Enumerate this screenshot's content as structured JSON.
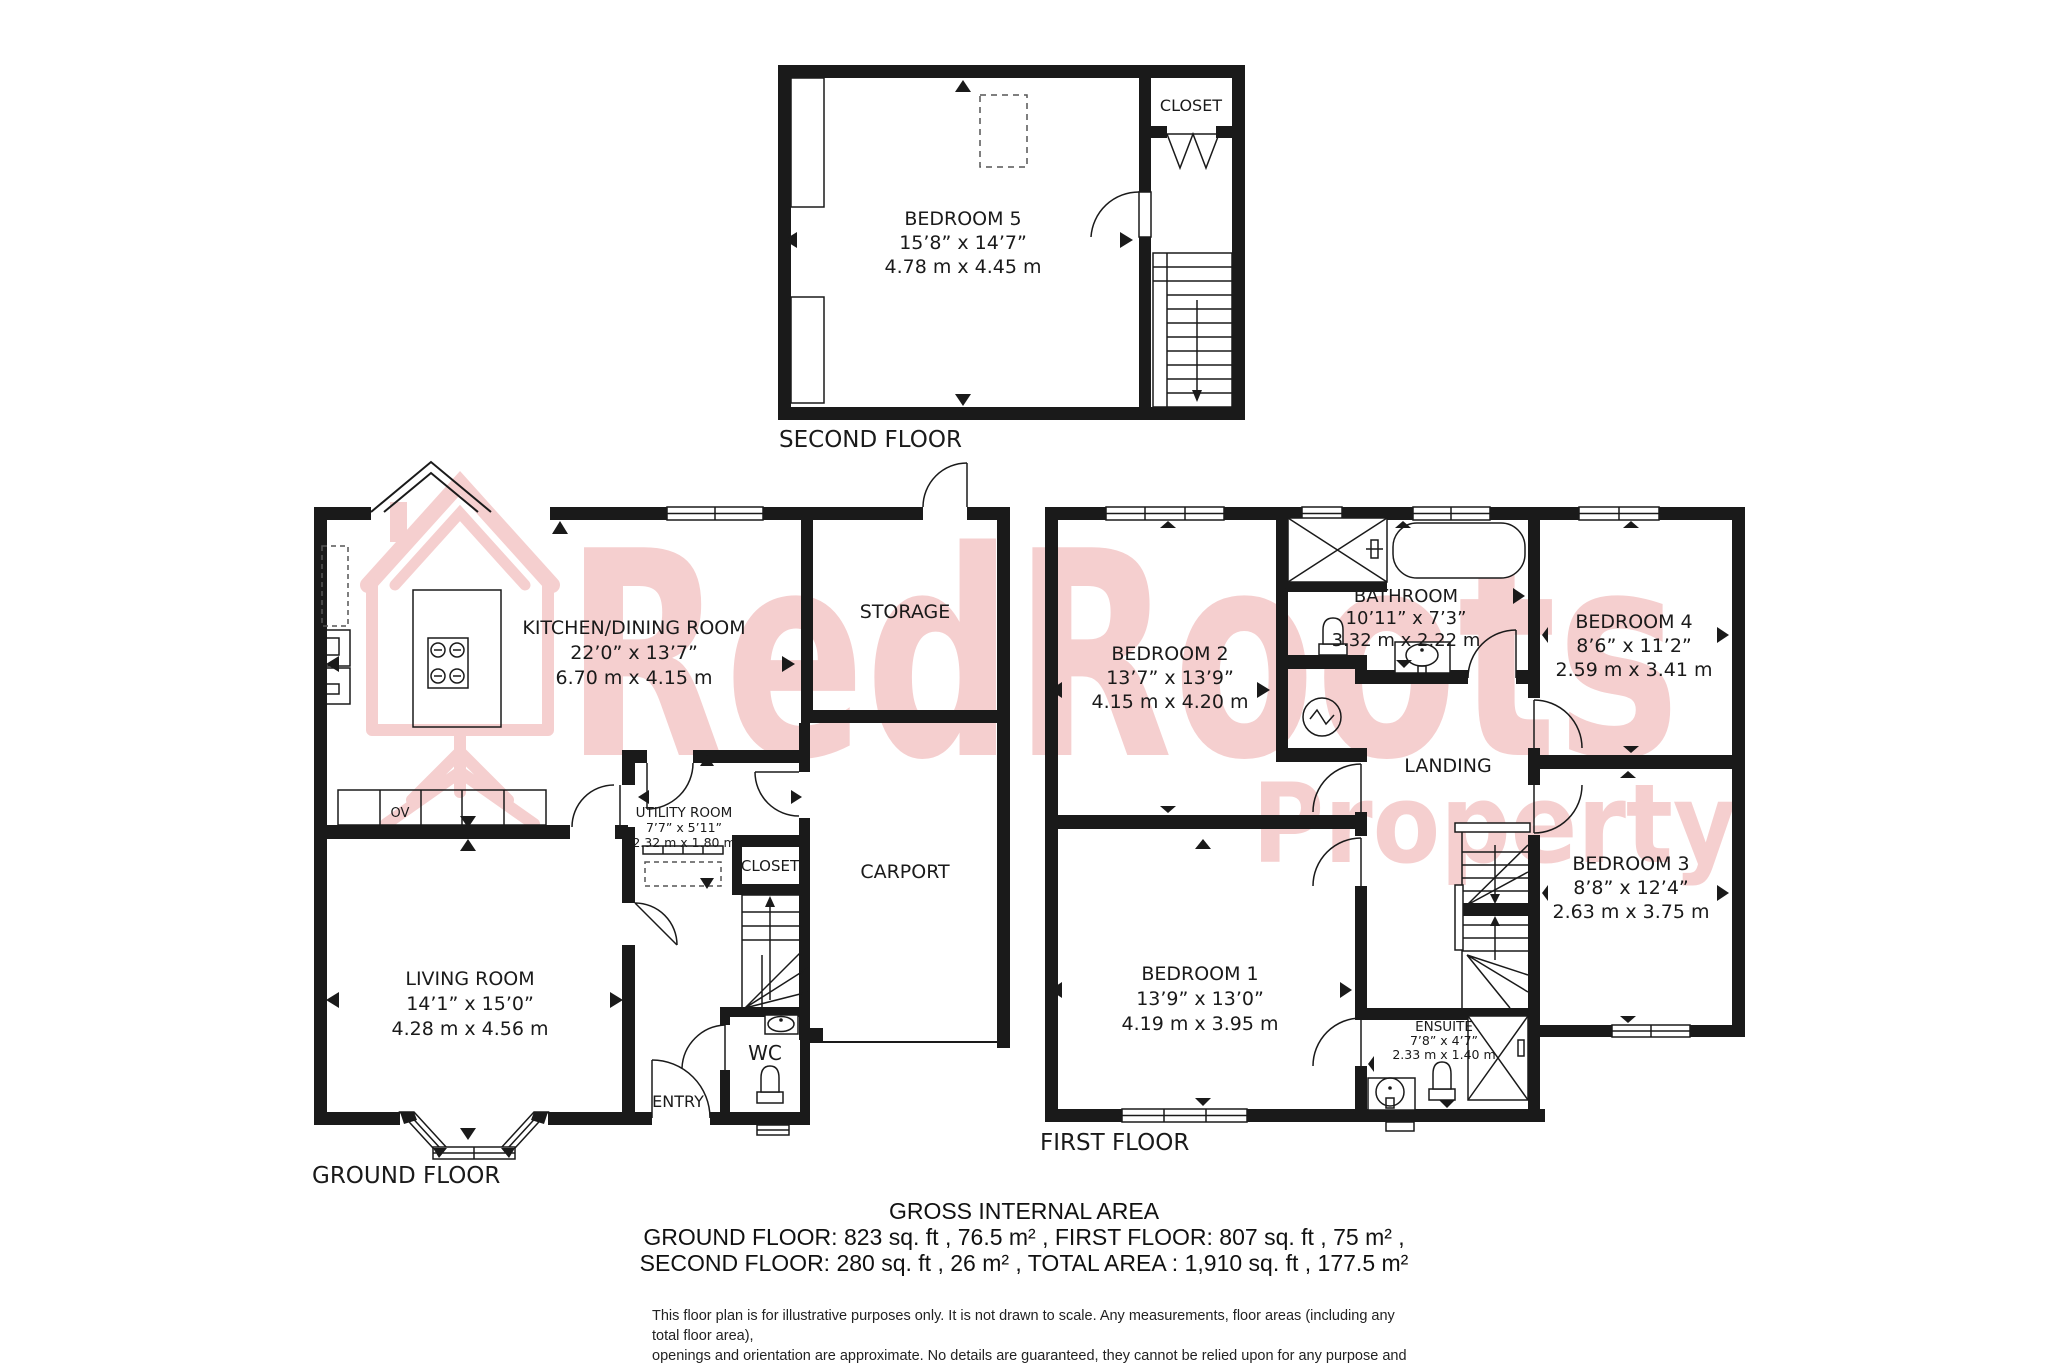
{
  "watermark": {
    "brand_top": "RedRoots",
    "brand_bottom": "Property",
    "color": "#f5cfcf"
  },
  "colors": {
    "wall": "#1a1a1a",
    "text": "#1a1a1a",
    "background": "#ffffff"
  },
  "floors": {
    "second": {
      "label": "SECOND FLOOR",
      "rooms": {
        "bedroom5": {
          "name": "BEDROOM 5",
          "dims_ft": "15’8” x 14’7”",
          "dims_m": "4.78 m x 4.45 m"
        },
        "closet": {
          "name": "CLOSET"
        }
      }
    },
    "ground": {
      "label": "GROUND FLOOR",
      "rooms": {
        "kitchen": {
          "name": "KITCHEN/DINING ROOM",
          "dims_ft": "22’0” x 13’7”",
          "dims_m": "6.70 m x 4.15 m"
        },
        "storage": {
          "name": "STORAGE"
        },
        "carport": {
          "name": "CARPORT"
        },
        "utility": {
          "name": "UTILITY ROOM",
          "dims_ft": "7’7” x 5’11”",
          "dims_m": "2.32 m x 1.80 m"
        },
        "closet": {
          "name": "CLOSET"
        },
        "living": {
          "name": "LIVING ROOM",
          "dims_ft": "14’1” x 15’0”",
          "dims_m": "4.28 m x 4.56 m"
        },
        "wc": {
          "name": "WC"
        },
        "entry": {
          "name": "ENTRY"
        },
        "oven": {
          "name": "OV"
        }
      }
    },
    "first": {
      "label": "FIRST FLOOR",
      "rooms": {
        "bedroom1": {
          "name": "BEDROOM 1",
          "dims_ft": "13’9” x 13’0”",
          "dims_m": "4.19 m x 3.95 m"
        },
        "bedroom2": {
          "name": "BEDROOM 2",
          "dims_ft": "13’7” x 13’9”",
          "dims_m": "4.15 m x 4.20 m"
        },
        "bedroom3": {
          "name": "BEDROOM 3",
          "dims_ft": "8’8” x 12’4”",
          "dims_m": "2.63 m x 3.75 m"
        },
        "bedroom4": {
          "name": "BEDROOM 4",
          "dims_ft": "8’6” x 11’2”",
          "dims_m": "2.59 m x 3.41 m"
        },
        "bathroom": {
          "name": "BATHROOM",
          "dims_ft": "10’11” x 7’3”",
          "dims_m": "3.32 m x 2.22 m"
        },
        "ensuite": {
          "name": "ENSUITE",
          "dims_ft": "7’8” x 4’7”",
          "dims_m": "2.33 m x 1.40 m"
        },
        "landing": {
          "name": "LANDING"
        }
      }
    }
  },
  "summary": {
    "title": "GROSS INTERNAL AREA",
    "line1": "GROUND FLOOR: 823 sq. ft , 76.5 m² , FIRST FLOOR: 807 sq. ft , 75 m² ,",
    "line2": "SECOND FLOOR: 280 sq. ft , 26 m² , TOTAL AREA : 1,910 sq. ft , 177.5 m²"
  },
  "disclaimer": {
    "lines": [
      "This floor plan is for illustrative purposes only. It is not drawn to scale. Any measurements, floor areas (including any total floor area),",
      "openings and orientation are approximate. No details are guaranteed, they cannot be relied upon for any purpose and they do not form",
      "part of any agreement. No liability is taken for any error, omission or misstatement. A party must rely upon its own inspection(s)."
    ]
  }
}
